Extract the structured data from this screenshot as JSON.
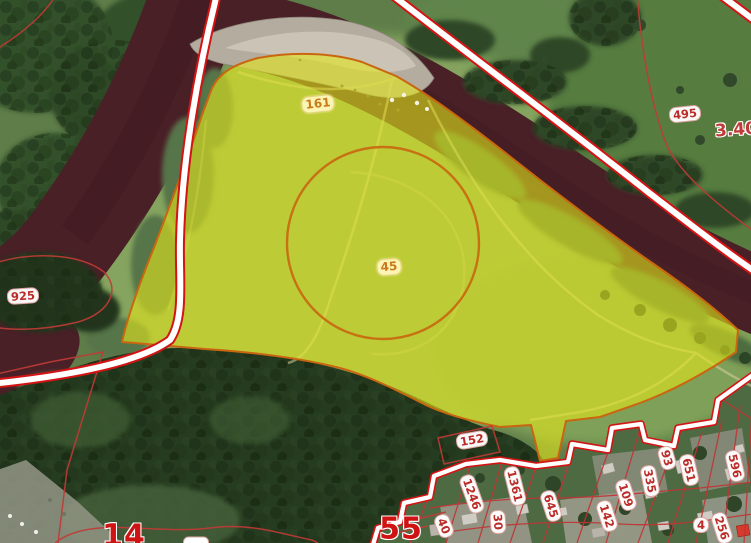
{
  "map": {
    "description": "Satellite cadastral map with a highlighted land parcel beside a river bend and a village of small parcels",
    "colors": {
      "highlighted_parcel_fill": "#d9e01a",
      "highlighted_parcel_border": "#c9660f",
      "cadastral_boundary_red": "#d41414",
      "thin_boundary_red": "#bf3b36",
      "village_parcel_red": "#c03434",
      "label_red": "#bb2b28",
      "label_orange": "#c8791b",
      "quarter_number_red": "#cf1212",
      "river_water": "#4a2027",
      "gravel_bar": "#b4ac9f"
    },
    "highlighted_parcel": {
      "number": "161",
      "inner_contour_number": "45"
    },
    "labels": [
      {
        "text": "161",
        "x": 318,
        "y": 104,
        "rot": -6,
        "style": "parcel-yellow"
      },
      {
        "text": "45",
        "x": 389,
        "y": 267,
        "rot": -4,
        "style": "parcel-yellow"
      },
      {
        "text": "495",
        "x": 685,
        "y": 114,
        "rot": -6,
        "style": "parcel-red"
      },
      {
        "text": "925",
        "x": 23,
        "y": 296,
        "rot": -4,
        "style": "parcel-red"
      },
      {
        "text": "152",
        "x": 472,
        "y": 440,
        "rot": -10,
        "style": "parcel-red"
      },
      {
        "text": "1246",
        "x": 472,
        "y": 494,
        "rot": 70,
        "style": "parcel-red"
      },
      {
        "text": "1361",
        "x": 515,
        "y": 486,
        "rot": 76,
        "style": "parcel-red"
      },
      {
        "text": "645",
        "x": 551,
        "y": 506,
        "rot": 72,
        "style": "parcel-red"
      },
      {
        "text": "40",
        "x": 444,
        "y": 526,
        "rot": 68,
        "style": "parcel-red"
      },
      {
        "text": "30",
        "x": 498,
        "y": 522,
        "rot": 86,
        "style": "parcel-red"
      },
      {
        "text": "93",
        "x": 667,
        "y": 458,
        "rot": 74,
        "style": "parcel-red"
      },
      {
        "text": "335",
        "x": 650,
        "y": 481,
        "rot": 79,
        "style": "parcel-red"
      },
      {
        "text": "651",
        "x": 689,
        "y": 470,
        "rot": 77,
        "style": "parcel-red"
      },
      {
        "text": "596",
        "x": 735,
        "y": 466,
        "rot": 77,
        "style": "parcel-red"
      },
      {
        "text": "109",
        "x": 626,
        "y": 495,
        "rot": 72,
        "style": "parcel-red"
      },
      {
        "text": "142",
        "x": 607,
        "y": 516,
        "rot": 72,
        "style": "parcel-red"
      },
      {
        "text": "256",
        "x": 722,
        "y": 528,
        "rot": 72,
        "style": "parcel-red"
      },
      {
        "text": "4",
        "x": 701,
        "y": 525,
        "rot": 0,
        "style": "parcel-red"
      },
      {
        "text": "55",
        "x": 401,
        "y": 529,
        "rot": 0,
        "style": "quarter-big"
      },
      {
        "text": "14",
        "x": 124,
        "y": 536,
        "rot": 0,
        "style": "quarter-big"
      },
      {
        "text": "3.40",
        "x": 736,
        "y": 130,
        "rot": -4,
        "style": "quarter-medium"
      },
      {
        "text": "",
        "x": 196,
        "y": 542,
        "rot": 0,
        "style": "truncated"
      }
    ]
  }
}
